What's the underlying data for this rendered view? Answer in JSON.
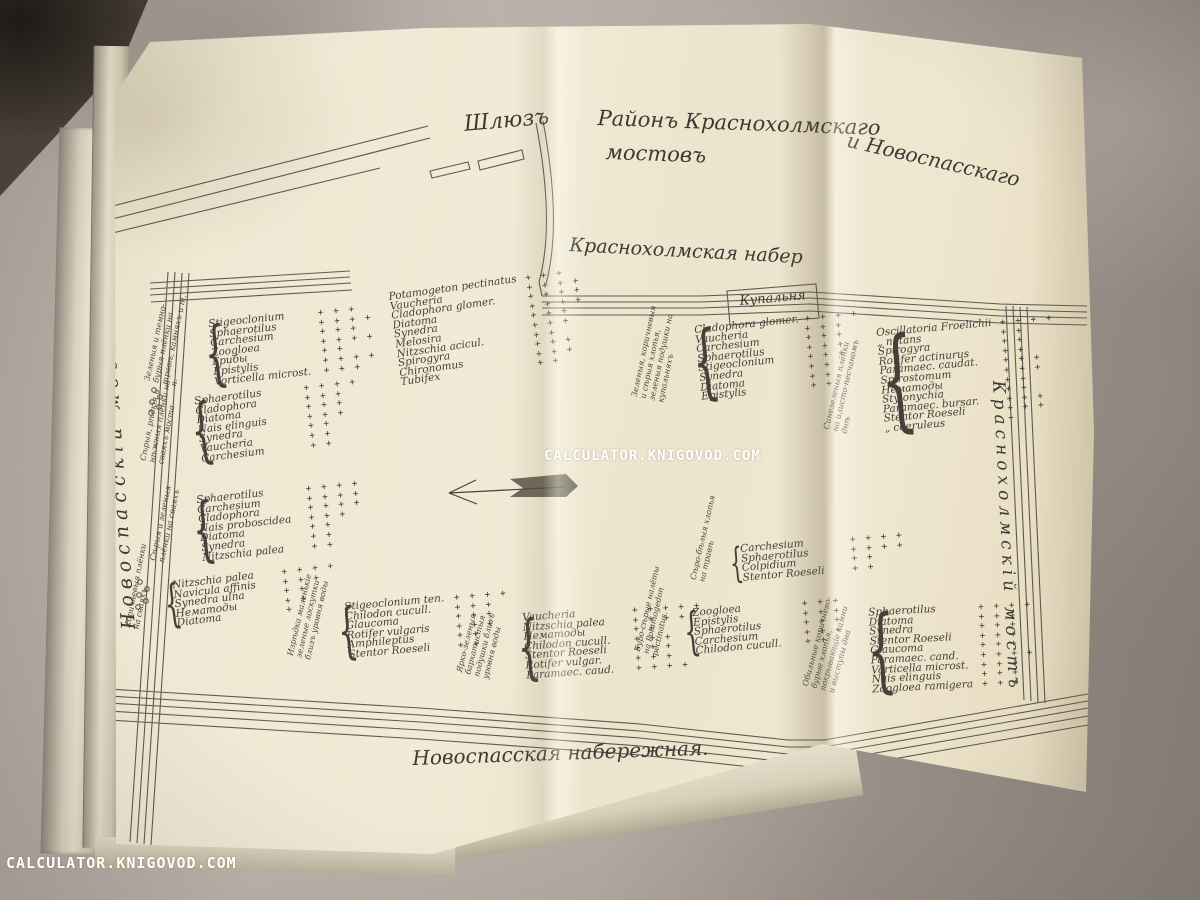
{
  "watermark": {
    "text": "CALCULATOR.KNIGOVOD.COM"
  },
  "icons": {
    "brace": "{",
    "current_arrow": "left-arrow"
  },
  "map": {
    "title_part1": "Районъ Краснохолмскаго",
    "title_part2": "и Новоспасскаго",
    "title_part3": "мостовъ",
    "sluice_label": "Шлюзъ",
    "upper_embankment": "Краснохолмская набер",
    "lower_embankment": "Новоспасская набережная.",
    "left_bridge": "Новоспасскій мостъ",
    "right_bridge": "Краснохолмскій мостъ",
    "bathhouse": "Купальня",
    "stations": [
      {
        "id": "A",
        "desc": "",
        "species": [
          {
            "name": "Potamogeton pectinatus",
            "plus": "+ + +"
          },
          {
            "name": "Vaucheria",
            "plus": "+ + + +"
          },
          {
            "name": "Cladophora glomer.",
            "plus": "+ + + +"
          },
          {
            "name": "Diatoma",
            "plus": "+ + + +"
          },
          {
            "name": "Synedra",
            "plus": "+ + +"
          },
          {
            "name": "Melosira",
            "plus": "+ + +"
          },
          {
            "name": "Nitzschia acicul.",
            "plus": "+ +"
          },
          {
            "name": "Spirogyra",
            "plus": "+ + +"
          },
          {
            "name": "Chironomus",
            "plus": "+ + +"
          },
          {
            "name": "Tubifex",
            "plus": "+ +"
          }
        ]
      },
      {
        "id": "B",
        "desc": "Зеленыя и темно-бурыя плёнки на травѣ, камняхъ и т. п.",
        "species": [
          {
            "name": "Stigeoclonium",
            "plus": "+ + +"
          },
          {
            "name": "Sphaerotilus",
            "plus": "+ + + +"
          },
          {
            "name": "Carchesium",
            "plus": "+ + +"
          },
          {
            "name": "Zoogloea",
            "plus": "+ + + +"
          },
          {
            "name": "Грибы",
            "plus": "+ +"
          },
          {
            "name": "Epistylis",
            "plus": "+ + + +"
          },
          {
            "name": "Vorticella microst.",
            "plus": "+ + +"
          }
        ]
      },
      {
        "id": "C",
        "desc": "Сѣрыя, рѣдкія и нѣжныя плёнки на сваяхъ моста",
        "species": [
          {
            "name": "Sphaerotilus",
            "plus": "+ + + +"
          },
          {
            "name": "Cladophora",
            "plus": "+ + +"
          },
          {
            "name": "Diatoma",
            "plus": "+ + +"
          },
          {
            "name": "Nais elinguis",
            "plus": "+ + +"
          },
          {
            "name": "Synedra",
            "plus": "+ +"
          },
          {
            "name": "Vaucheria",
            "plus": "+ +"
          },
          {
            "name": "Carchesium",
            "plus": "+ +"
          }
        ]
      },
      {
        "id": "D",
        "desc": "Сѣрыя и зеленыя плёнки на сваяхъ",
        "species": [
          {
            "name": "Sphaerotilus",
            "plus": "+ + + +"
          },
          {
            "name": "Carchesium",
            "plus": "+ + + +"
          },
          {
            "name": "Cladophora",
            "plus": "+ + + +"
          },
          {
            "name": "Nais proboscidea",
            "plus": "+ + +"
          },
          {
            "name": "Diatoma",
            "plus": "+ +"
          },
          {
            "name": "Synedra",
            "plus": "+ +"
          },
          {
            "name": "Nitzschia palea",
            "plus": "+ +"
          }
        ]
      },
      {
        "id": "E",
        "desc": "Коричневыя плёнки на сваяхъ",
        "species": [
          {
            "name": "Nitzschia palea",
            "plus": "+ + + +"
          },
          {
            "name": "Navicula affinis",
            "plus": "+ + +"
          },
          {
            "name": "Synedra ulna",
            "plus": "+ +"
          },
          {
            "name": "Нематоды",
            "plus": "+ +"
          },
          {
            "name": "Diatoma",
            "plus": "+"
          }
        ]
      },
      {
        "id": "F",
        "desc": "Изрѣдка маленькіе зеленые лоскутки близъ уровня воды",
        "species": [
          {
            "name": "Stigeoclonium ten.",
            "plus": "+ + + +"
          },
          {
            "name": "Chilodon cucull.",
            "plus": "+ + +"
          },
          {
            "name": "Glaucoma",
            "plus": "+ + +"
          },
          {
            "name": "Rotifer vulgaris",
            "plus": "+ + +"
          },
          {
            "name": "Amphileptus",
            "plus": "+ +"
          },
          {
            "name": "Stentor Roeseli",
            "plus": "+ +"
          }
        ]
      },
      {
        "id": "G",
        "desc": "Ярко-зеленыя бархатистыя подушки близъ уровня воды",
        "species": [
          {
            "name": "Vaucheria",
            "plus": "+ + + + +"
          },
          {
            "name": "Nitzschia palea",
            "plus": "+ + + +"
          },
          {
            "name": "Нематоды",
            "plus": "+ +"
          },
          {
            "name": "Chilodon cucull.",
            "plus": "+ + +"
          },
          {
            "name": "Stentor Roeseli",
            "plus": "+ + +"
          },
          {
            "name": "Rotifer vulgar.",
            "plus": "+ + +"
          },
          {
            "name": "Paramaec. caud.",
            "plus": "+ + + +"
          }
        ]
      },
      {
        "id": "H",
        "desc": "Буро-сѣрые налёты на Potamogedon pectinatus.",
        "species": [
          {
            "name": "Zoogloea",
            "plus": "+ + +"
          },
          {
            "name": "Epistylis",
            "plus": "+ + +"
          },
          {
            "name": "Sphaerotilus",
            "plus": "+ + +"
          },
          {
            "name": "Carchesium",
            "plus": "+ + +"
          },
          {
            "name": "Chilodon cucull.",
            "plus": "+ +"
          }
        ]
      },
      {
        "id": "I",
        "desc": "Обильные коричнево-бурые хлопья, покрывающіе камни и выступы дна",
        "species": [
          {
            "name": "Sphaerotilus",
            "plus": "+ + + +"
          },
          {
            "name": "Diatoma",
            "plus": "+ + +"
          },
          {
            "name": "Synedra",
            "plus": "+ + +"
          },
          {
            "name": "Stentor Roeseli",
            "plus": "+ + +"
          },
          {
            "name": "Glaucoma",
            "plus": "+ + +"
          },
          {
            "name": "Paramaec. cand.",
            "plus": "+ + + +"
          },
          {
            "name": "Vorticella microst.",
            "plus": "+ + +"
          },
          {
            "name": "Nais elinguis",
            "plus": "+ + +"
          },
          {
            "name": "Zoogloea ramigera",
            "plus": "+ + +"
          }
        ]
      },
      {
        "id": "J",
        "desc": "Сѣро-бѣлыя хлопья на травѣ",
        "species": [
          {
            "name": "Carchesium",
            "plus": "+ + + +"
          },
          {
            "name": "Sphaerotilus",
            "plus": "+ + + +"
          },
          {
            "name": "Colpidium",
            "plus": "+ +"
          },
          {
            "name": "Stentor Roeseli",
            "plus": "+ +"
          }
        ]
      },
      {
        "id": "K",
        "desc": "Зеленыя, коричневыя и сѣрыя хлопья, зеленыя подушки на купальняхъ",
        "species": [
          {
            "name": "Cladophora glomer.",
            "plus": "+ + + +"
          },
          {
            "name": "Vaucheria",
            "plus": "+ + +"
          },
          {
            "name": "Carchesium",
            "plus": "+ + +"
          },
          {
            "name": "Sphaerotilus",
            "plus": "+ + +"
          },
          {
            "name": "Stigeoclonium",
            "plus": "+ + +"
          },
          {
            "name": "Synedra",
            "plus": "+ +"
          },
          {
            "name": "Diatoma",
            "plus": "+ +"
          },
          {
            "name": "Epistylis",
            "plus": "+ +"
          }
        ]
      },
      {
        "id": "L",
        "desc": "Синезеленыя плёнки на илисто-песчаномъ днѣ",
        "species": [
          {
            "name": "Oscillatoria Froelichii",
            "plus": "+ + + +"
          },
          {
            "name": "„ natans",
            "plus": "+ +"
          },
          {
            "name": "Spirogyra",
            "plus": "+ +"
          },
          {
            "name": "Rotifer actinurus",
            "plus": "+ +"
          },
          {
            "name": "Paramaec. caudat.",
            "plus": "+ + +"
          },
          {
            "name": "Spirostomum",
            "plus": "+ + +"
          },
          {
            "name": "Нематоды",
            "plus": "+ +"
          },
          {
            "name": "Stylonychia",
            "plus": "+ +"
          },
          {
            "name": "Paramaec. bursar.",
            "plus": "+ + +"
          },
          {
            "name": "Stentor Roeseli",
            "plus": "+ + +"
          },
          {
            "name": "„ coeruleus",
            "plus": "+"
          }
        ]
      }
    ]
  }
}
